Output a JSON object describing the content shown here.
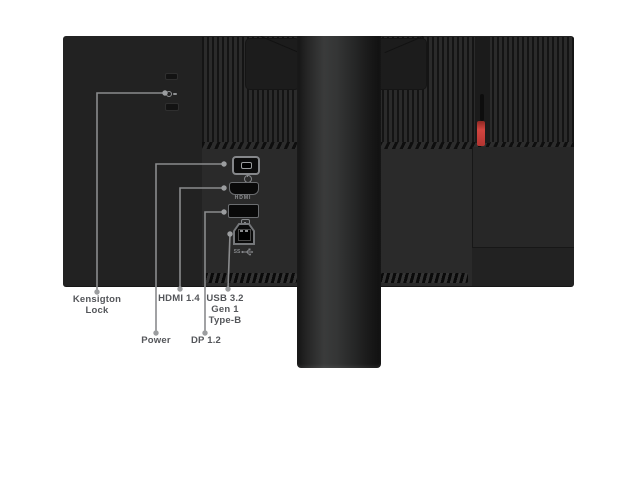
{
  "figure": {
    "type": "product-port-callout-diagram",
    "subject": "monitor rear panel with stand"
  },
  "colors": {
    "background": "#ffffff",
    "monitor_body": "#222222",
    "accent_red": "#c23c36",
    "leader_line_gray": "#8a8b8d",
    "label_gray": "#54565a"
  },
  "callouts": {
    "kensington": {
      "label": "Kensigton\nLock"
    },
    "power": {
      "label": "Power"
    },
    "hdmi": {
      "label": "HDMI 1.4"
    },
    "dp": {
      "label": "DP 1.2"
    },
    "usb": {
      "label": "USB 3.2\nGen 1\nType-B"
    }
  },
  "port_markings": {
    "hdmi_text": "HDMI",
    "usb_ss_text": "SS"
  }
}
